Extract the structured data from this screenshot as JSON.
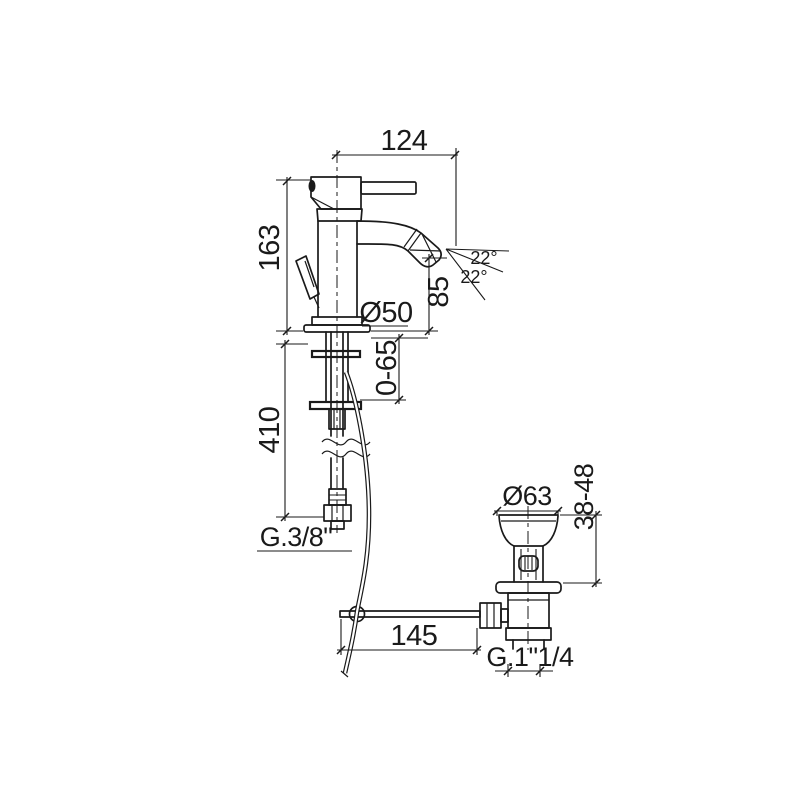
{
  "drawing": {
    "title": "bidet-mixer-technical-drawing",
    "line_color": "#1a1a1a",
    "background": "#ffffff",
    "labels": {
      "spout_reach": "124",
      "height_to_deck": "163",
      "spout_height": "85",
      "spray_angle_up": "22°",
      "spray_angle_down": "22°",
      "base_diameter": "Ø50",
      "deck_range": "0-65",
      "hose_length": "410",
      "supply_thread": "G.3/8\"",
      "waste_diameter": "Ø63",
      "waste_clamp_range": "38-48",
      "rod_length": "145",
      "waste_thread": "G.1\"1/4"
    }
  }
}
